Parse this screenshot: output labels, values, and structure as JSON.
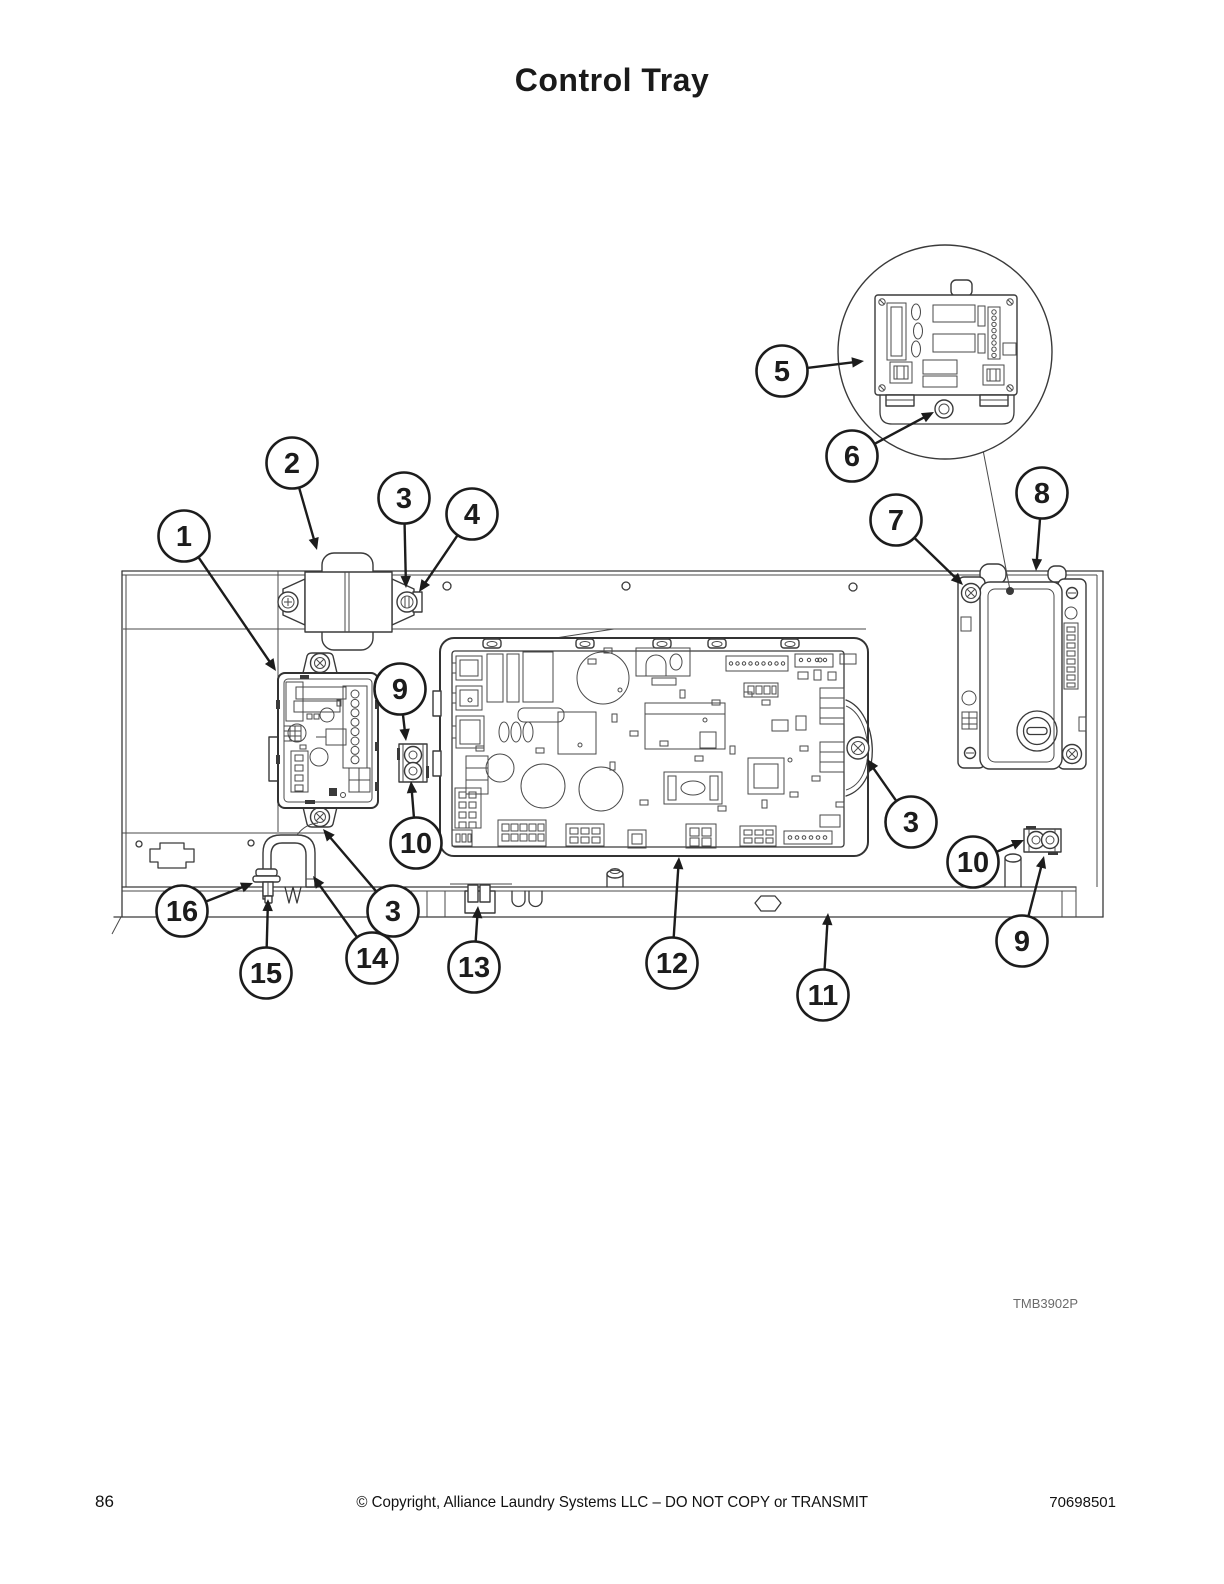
{
  "page": {
    "title": "Control Tray",
    "figure_code": "TMB3902P",
    "footer": {
      "page_number": "86",
      "copyright": "© Copyright, Alliance Laundry Systems LLC – DO NOT COPY or TRANSMIT",
      "document_number": "70698501"
    }
  },
  "diagram": {
    "type": "parts-callout-diagram",
    "subject": "Control tray assembly: small control board, transformer, main control board, display module, terminal blocks, wire clamp and fasteners",
    "part_numbers_shown": [
      "1",
      "2",
      "3",
      "4",
      "5",
      "6",
      "7",
      "8",
      "9",
      "10",
      "11",
      "12",
      "13",
      "14",
      "15",
      "16"
    ],
    "colors": {
      "line": "#3a3a3a",
      "callout": "#1c1c1c",
      "background": "#ffffff",
      "label_gray": "#6b6b6b"
    },
    "callouts": [
      {
        "label": "1",
        "cx": 184,
        "cy": 536,
        "tx": 276,
        "ty": 671
      },
      {
        "label": "2",
        "cx": 292,
        "cy": 463,
        "tx": 317,
        "ty": 550
      },
      {
        "label": "3",
        "cx": 404,
        "cy": 498,
        "tx": 406,
        "ty": 588
      },
      {
        "label": "4",
        "cx": 472,
        "cy": 514,
        "tx": 419,
        "ty": 592
      },
      {
        "label": "5",
        "cx": 782,
        "cy": 371,
        "tx": 864,
        "ty": 361
      },
      {
        "label": "6",
        "cx": 852,
        "cy": 456,
        "tx": 934,
        "ty": 412
      },
      {
        "label": "7",
        "cx": 896,
        "cy": 520,
        "tx": 963,
        "ty": 585
      },
      {
        "label": "8",
        "cx": 1042,
        "cy": 493,
        "tx": 1036,
        "ty": 571
      },
      {
        "label": "9",
        "cx": 400,
        "cy": 689,
        "tx": 406,
        "ty": 741
      },
      {
        "label": "10",
        "cx": 416,
        "cy": 843,
        "tx": 411,
        "ty": 781
      },
      {
        "label": "3",
        "cx": 911,
        "cy": 822,
        "tx": 867,
        "ty": 759
      },
      {
        "label": "10",
        "cx": 973,
        "cy": 862,
        "tx": 1024,
        "ty": 840
      },
      {
        "label": "9",
        "cx": 1022,
        "cy": 941,
        "tx": 1044,
        "ty": 856
      },
      {
        "label": "16",
        "cx": 182,
        "cy": 911,
        "tx": 253,
        "ty": 883
      },
      {
        "label": "15",
        "cx": 266,
        "cy": 973,
        "tx": 268,
        "ty": 899
      },
      {
        "label": "14",
        "cx": 372,
        "cy": 958,
        "tx": 313,
        "ty": 876
      },
      {
        "label": "3",
        "cx": 393,
        "cy": 911,
        "tx": 323,
        "ty": 829
      },
      {
        "label": "13",
        "cx": 474,
        "cy": 967,
        "tx": 478,
        "ty": 906
      },
      {
        "label": "12",
        "cx": 672,
        "cy": 963,
        "tx": 679,
        "ty": 857
      },
      {
        "label": "11",
        "cx": 823,
        "cy": 995,
        "tx": 828,
        "ty": 913
      }
    ],
    "detail_bubble": {
      "center_x": 945,
      "center_y": 352,
      "radius": 107,
      "leader_from_x": 983,
      "leader_from_y": 450,
      "leader_to_x": 1010,
      "leader_to_y": 590,
      "callout_labels": [
        "5",
        "6"
      ]
    }
  }
}
